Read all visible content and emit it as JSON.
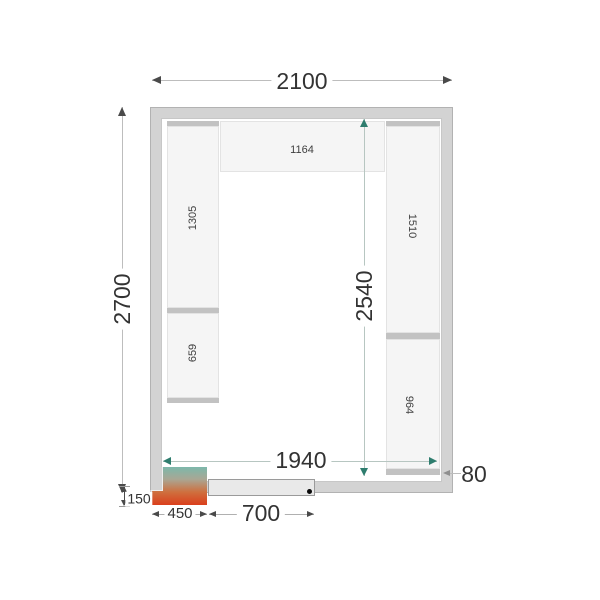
{
  "diagram": {
    "kind": "cold-room floor plan (top view)"
  },
  "dims": {
    "outer_width": "2100",
    "outer_depth": "2700",
    "inner_width": "1940",
    "inner_depth": "2540",
    "wall_thickness": "80",
    "unit_offset": "150",
    "unit_width": "450",
    "door_width": "700"
  },
  "shelves": {
    "top": "1164",
    "left_upper": "1305",
    "left_lower": "659",
    "right_upper": "1510",
    "right_lower": "964"
  },
  "colors": {
    "wall": "#d3d3d3",
    "shelf_fill": "#f5f5f5",
    "shelf_cap": "#c2c2c2",
    "arrow_dark": "#4a4a4a",
    "arrow_teal": "#2e7d6e",
    "door_fill": "#e9e9e9",
    "hinge_dot": "#0a0a0a",
    "unit_gradient_top": "#7cb8ab",
    "unit_gradient_mid": "#cf6f3e",
    "unit_gradient_bottom": "#da3f1c"
  }
}
